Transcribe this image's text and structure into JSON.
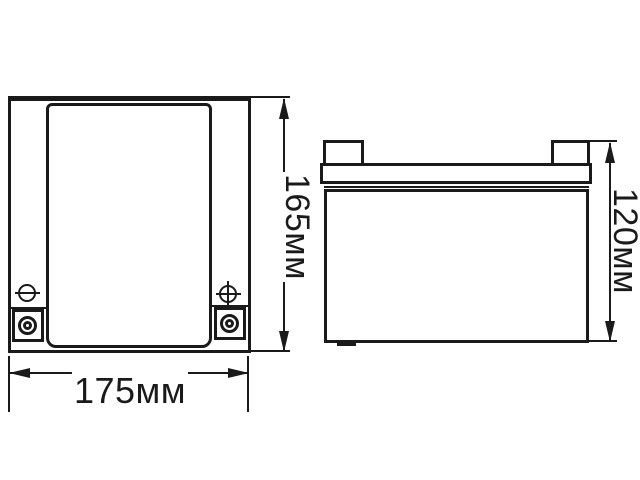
{
  "drawing": {
    "type": "technical-dimension-diagram",
    "subject": "battery two-view outline drawing",
    "colors": {
      "ink": "#1a1a1a",
      "background": "#ffffff"
    },
    "views": {
      "front": {
        "name": "front-view"
      },
      "side": {
        "name": "side-view"
      }
    },
    "dimensions": {
      "front_height": {
        "label": "165мм",
        "orientation": "vertical"
      },
      "front_width": {
        "label": "175мм",
        "orientation": "horizontal"
      },
      "side_height": {
        "label": "120мм",
        "orientation": "vertical"
      }
    },
    "icons": {
      "negative_terminal": "minus-in-circle",
      "positive_terminal": "plus-in-circle",
      "terminal_posts": "concentric-circles-in-square"
    }
  }
}
